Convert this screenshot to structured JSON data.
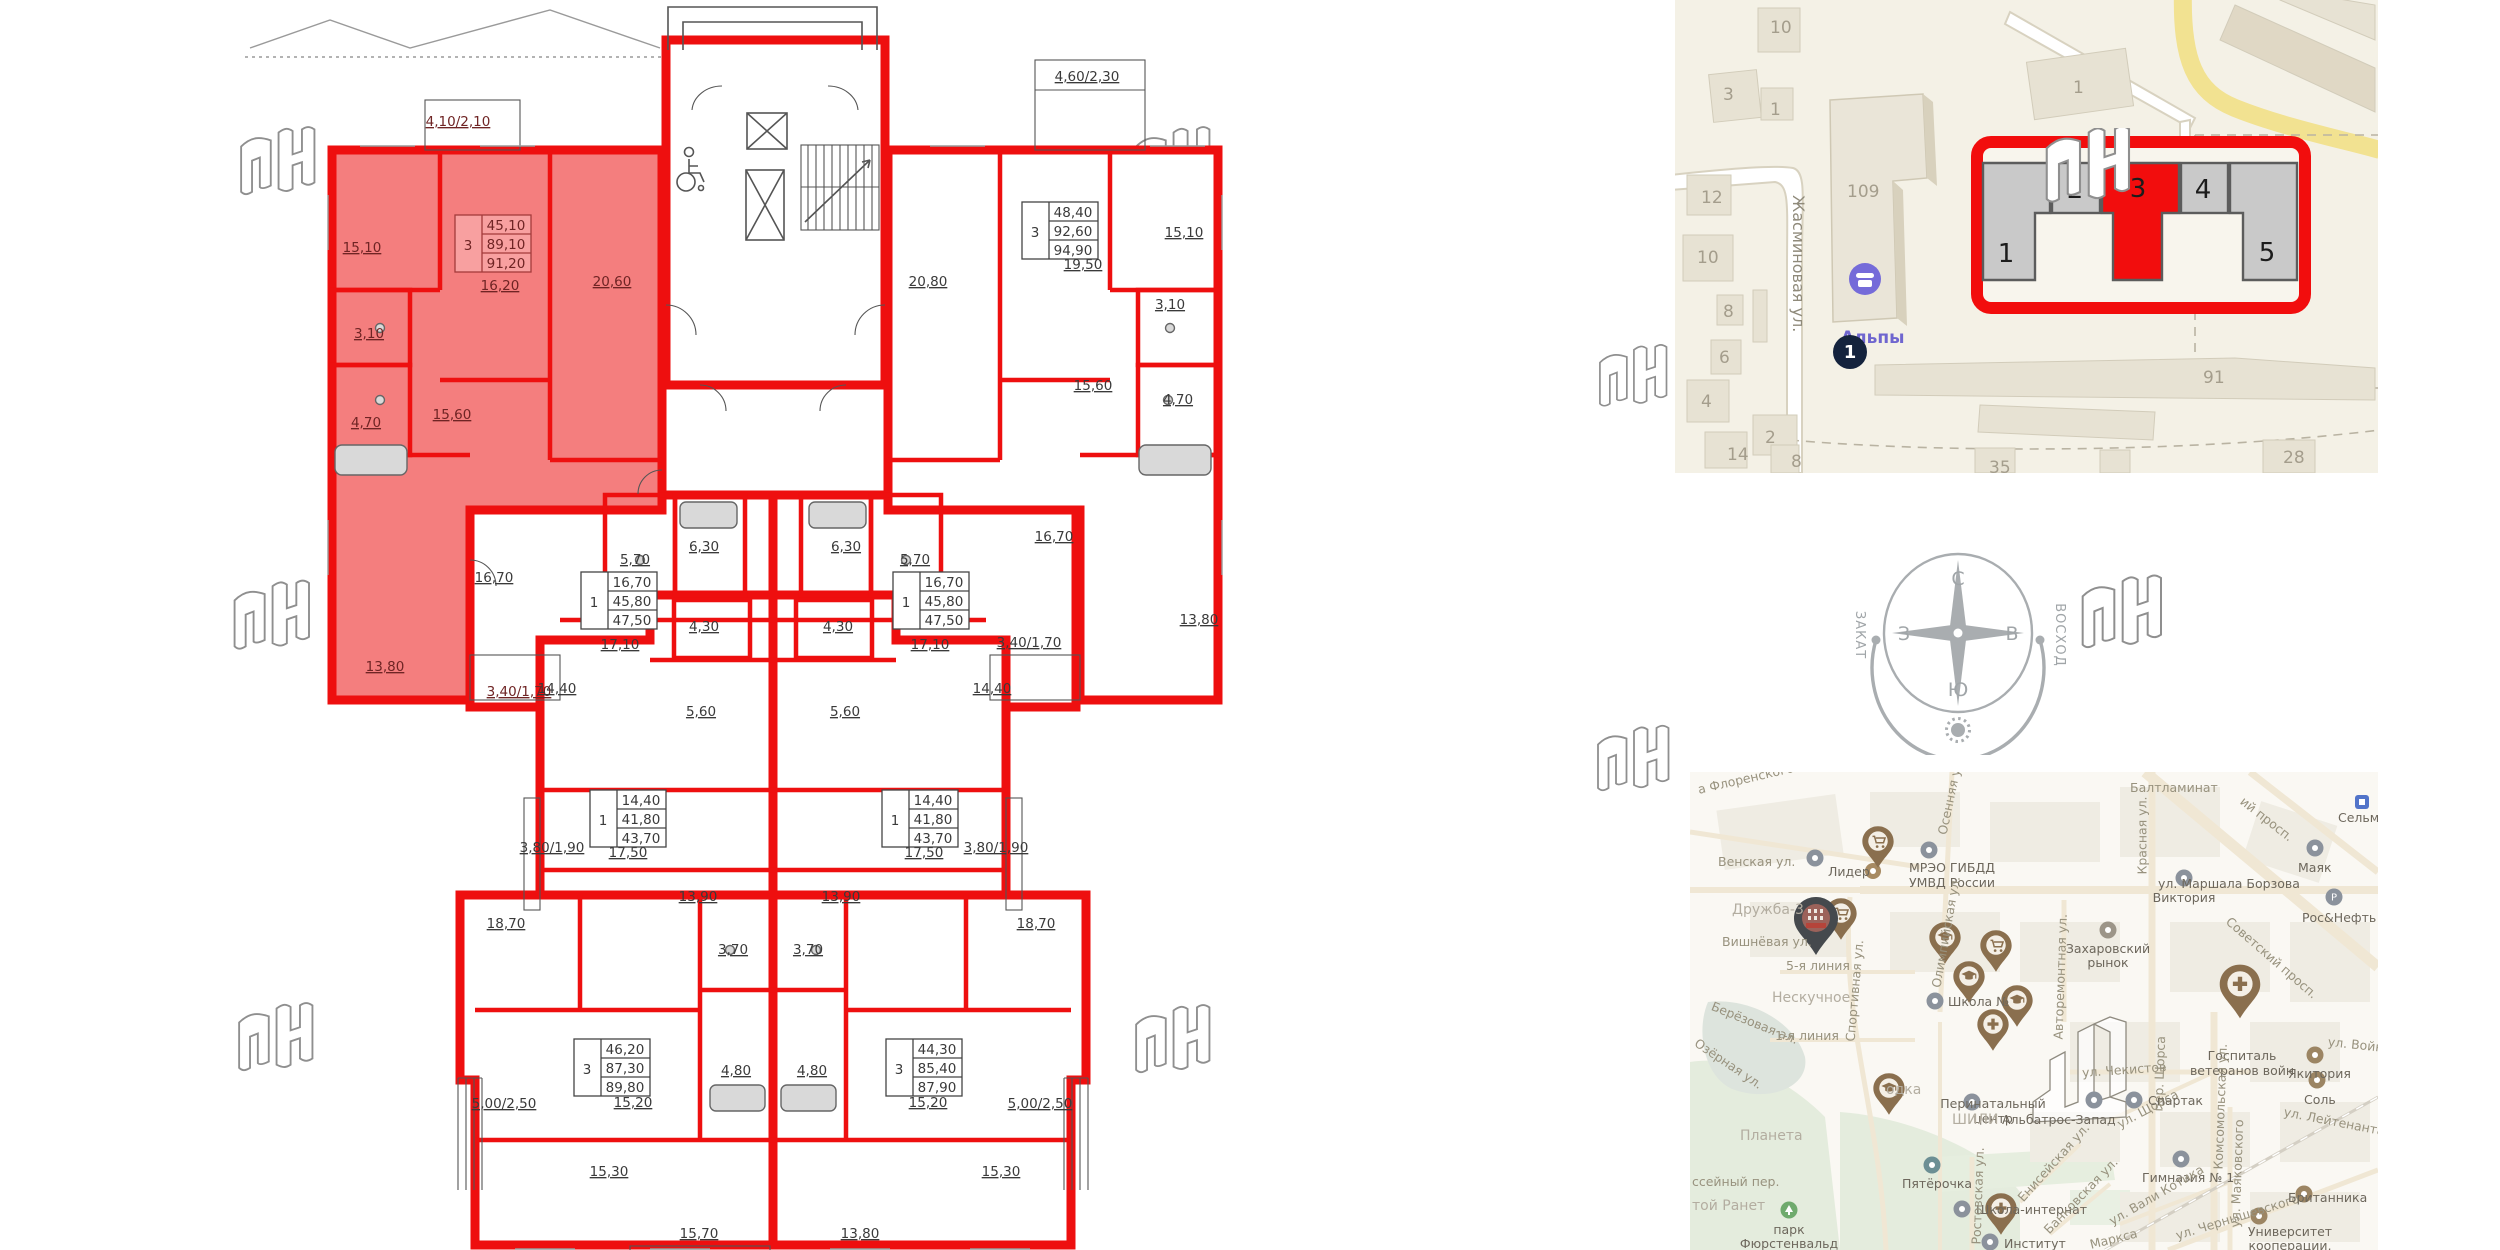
{
  "colors": {
    "wall_red": "#ee0f0f",
    "apartment_highlight": "#f47e7e",
    "schematic_red": "#f20d0d",
    "pin_brown": "#8a6f4e",
    "pin_dark": "#45494d",
    "poi_purple": "#756bd9",
    "badge_navy": "#14233d",
    "site_map_bg": "#f4f1e6",
    "yellow_road": "#efdd8e",
    "compass_gray": "#a0a5a8"
  },
  "floorplan": {
    "tables": [
      {
        "rooms": "3",
        "v1": "45,10",
        "v2": "89,10",
        "v3": "91,20"
      },
      {
        "rooms": "3",
        "v1": "48,40",
        "v2": "92,60",
        "v3": "94,90"
      },
      {
        "rooms": "1",
        "v1": "16,70",
        "v2": "45,80",
        "v3": "47,50"
      },
      {
        "rooms": "1",
        "v1": "14,40",
        "v2": "41,80",
        "v3": "43,70"
      },
      {
        "rooms": "3",
        "v1": "46,20",
        "v2": "87,30",
        "v3": "89,80"
      },
      {
        "rooms": "3",
        "v1": "44,30",
        "v2": "85,40",
        "v3": "87,90"
      }
    ],
    "labels": [
      "15,10",
      "4,10/2,10",
      "16,20",
      "20,60",
      "3,10",
      "4,70",
      "15,60",
      "13,80",
      "3,40/1,70",
      "4,60/2,30",
      "20,80",
      "19,50",
      "15,10",
      "3,10",
      "15,60",
      "4,70",
      "13,80",
      "3,40/1,70",
      "5,70",
      "6,30",
      "16,70",
      "17,10",
      "6,30",
      "5,70",
      "16,70",
      "17,10",
      "4,30",
      "5,60",
      "14,40",
      "17,50",
      "3,80/1,90",
      "13,90",
      "4,30",
      "5,60",
      "14,40",
      "17,50",
      "3,80/1,90",
      "13,90",
      "18,70",
      "3,70",
      "15,20",
      "4,80",
      "5,00/2,50",
      "15,30",
      "15,70",
      "18,70",
      "3,70",
      "15,20",
      "4,80",
      "5,00/2,50",
      "15,30",
      "13,80"
    ]
  },
  "site_map": {
    "street": "Жасминовая ул.",
    "poi_label": "Альпы",
    "map_label": "Альпы",
    "badge": "1",
    "numbers": [
      "10",
      "3",
      "1",
      "1",
      "12",
      "10",
      "8",
      "6",
      "4",
      "2",
      "109",
      "91",
      "14",
      "8",
      "35",
      "28"
    ],
    "schematic": {
      "sections": [
        "1",
        "2",
        "3",
        "4",
        "5"
      ],
      "highlighted_section": "3"
    }
  },
  "compass": {
    "n": "С",
    "e": "В",
    "s": "Ю",
    "w": "З",
    "sunset": "ЗАКАТ",
    "sunrise": "ВОСХОД"
  },
  "city_map": {
    "labels": [
      "а Флоренского",
      "Балтламинат",
      "ий просп.",
      "Сельма",
      "Венская ул.",
      "Лидер",
      "МРЭО ГИБДД",
      "УМВД России",
      "Осенняя ул.",
      "Красная ул.",
      "Маяк",
      "Рос&Нефть",
      "ул. Маршала Борзова",
      "Виктория",
      "Дружба-3",
      "Вишнёвая ул.",
      "Советский просп.",
      "Захаровский рынок",
      "Олимпийская ул.",
      "5-я линия",
      "Нескучное",
      "Школа №",
      "Авторемонтная ул.",
      "Берёзовая ал.",
      "1-я линия",
      "Озёрная ул.",
      "Госпиталь",
      "ветеранов войн",
      "Якитория",
      "ул. Войн...",
      "пер. Щорса",
      "Комсомольская ул.",
      "ул. Щорса",
      "Соль",
      "ул. Лейтенанта Янал...",
      "Перинатальный",
      "центр",
      "Спартак",
      "Альбатрос-Запад",
      "ул. Чекистов",
      "ШИЛИ",
      "Спортивная ул.",
      "Планета",
      "ссейный пер.",
      "той Ранет",
      "парк",
      "Фюрстенвальд",
      "Школа-интернат",
      "Пятёрочка",
      "Ростовская ул.",
      "Енисейская ул.",
      "Банковская ул.",
      "Гимназия № 1",
      "ул. Вали Котика",
      "ул. Маяковского",
      "ул. Чернышевского",
      "Британника",
      "Университет",
      "кооперации,",
      "Маркса",
      "одка",
      "Институт"
    ]
  }
}
